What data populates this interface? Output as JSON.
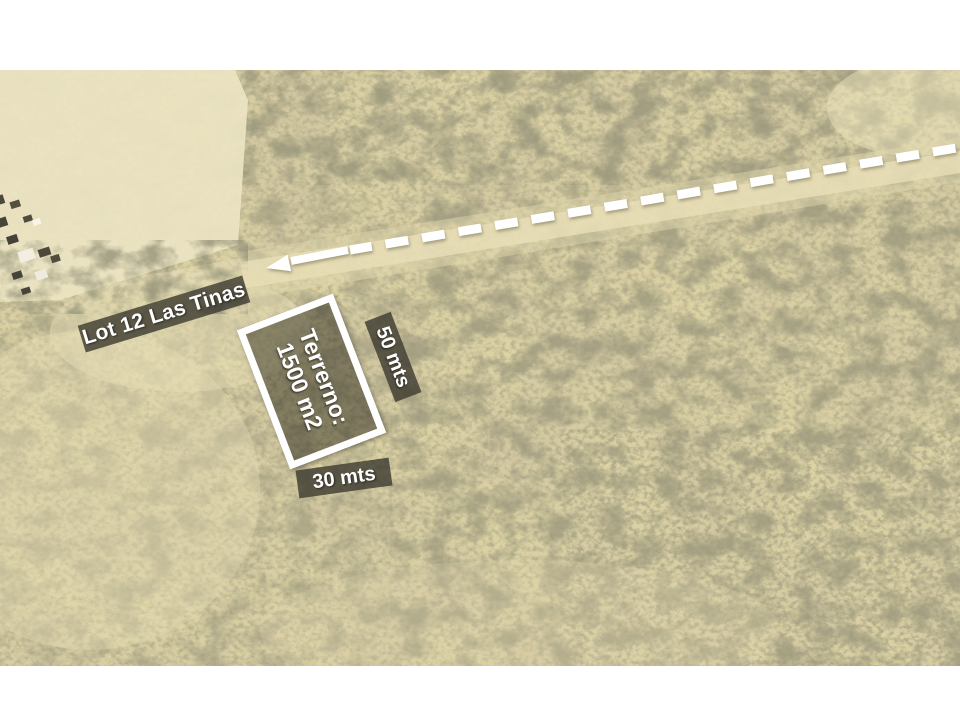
{
  "slide": {
    "background": "#ffffff",
    "photo_top": 70,
    "photo_height": 596
  },
  "map": {
    "kind": "satellite aerial photo",
    "terrain": "desert scrubland with sandy road",
    "colors": {
      "sand_base": "#dcd2a4",
      "sand_light": "#ece4c2",
      "road_sand": "#e8dfb8",
      "vegetation_dark": "#4d4b31",
      "annotation_band_bg": "rgba(60,58,48,0.80)",
      "annotation_text": "#ffffff",
      "lot_outline": "#ffffff",
      "arrow": "#ffffff"
    }
  },
  "annotations": {
    "lot_label": "Lot 12 Las Tinas",
    "terrain_line1": "Terrerno:",
    "terrain_line2": "1500 m2",
    "dim_long": "50 mts",
    "dim_short": "30 mts",
    "arrow_style": "dashed, pointing left toward lot"
  }
}
